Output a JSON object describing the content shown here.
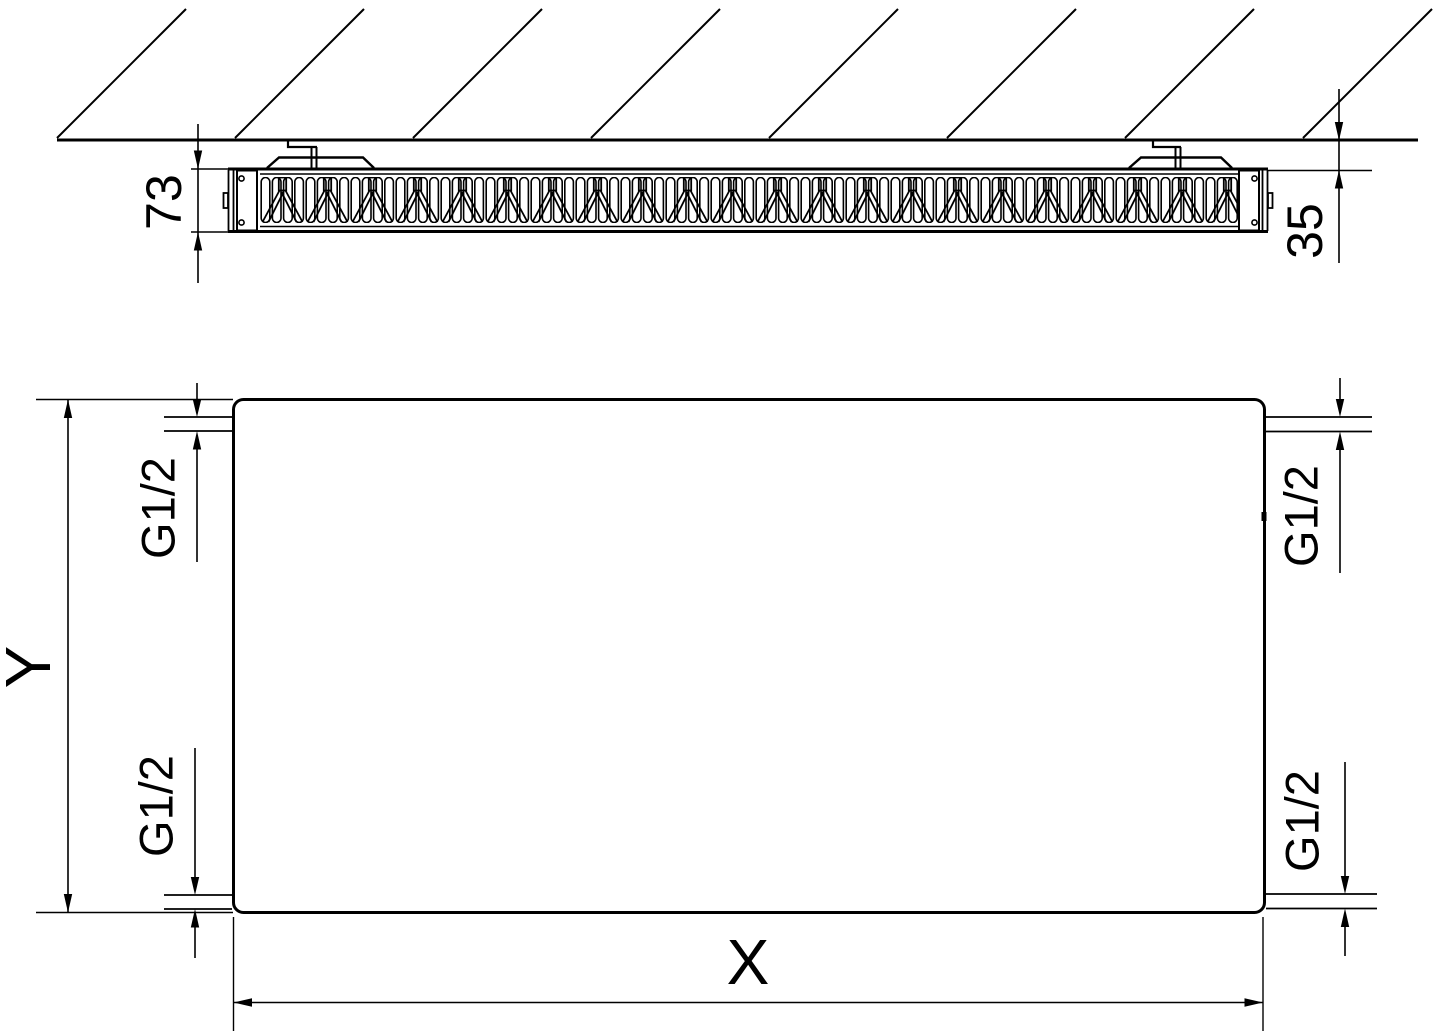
{
  "labels": {
    "top_view": {
      "depth": "73",
      "wall_gap": "35"
    },
    "front_view": {
      "height": "Y",
      "width": "X",
      "connections": [
        {
          "position": "top-left",
          "label": "G1/2"
        },
        {
          "position": "bottom-left",
          "label": "G1/2"
        },
        {
          "position": "top-right",
          "label": "G1/2"
        },
        {
          "position": "bottom-right",
          "label": "G1/2"
        }
      ]
    }
  },
  "colors": {
    "line": "#000000",
    "background": "#ffffff"
  }
}
